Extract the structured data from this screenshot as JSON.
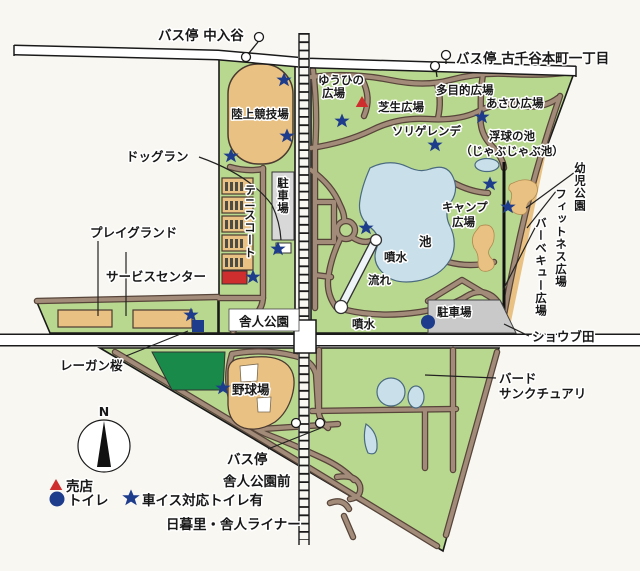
{
  "map_title_context": "舎人公園 園内マップ",
  "bus_stops": {
    "nakairiya": "バス停 中入谷",
    "kojiya_honcho": "バス停 古千谷本町一丁目",
    "toneri_koen_mae_line1": "バス停",
    "toneri_koen_mae_line2": "舎人公園前"
  },
  "labels": {
    "athletics_field": "陸上競技場",
    "dog_run": "ドッグラン",
    "tennis_court": "テニスコート",
    "parking_north": "駐車場",
    "playground": "プレイグランド",
    "service_center": "サービスセンター",
    "reagan_sakura": "レーガン桜",
    "station_name": "舎人公園",
    "yuhi_plaza_line1": "ゆうひの",
    "yuhi_plaza_line2": "広場",
    "shibafu_plaza": "芝生広場",
    "tamokuteki_plaza": "多目的広場",
    "asahi_plaza": "あさひ広場",
    "sori_gelande": "ソリゲレンデ",
    "ukidama_pond_line1": "浮球の池",
    "ukidama_pond_line2": "（じゃぶじゃぶ池）",
    "camp_plaza_line1": "キャンプ",
    "camp_plaza_line2": "広場",
    "pond": "池",
    "fountain_upper": "噴水",
    "stream": "流れ",
    "fountain_lower": "噴水",
    "parking_south": "駐車場",
    "yoji_koen": "幼児公園",
    "fitness_plaza": "フィットネス広場",
    "bbq_plaza": "バーベキュー広場",
    "shobu_den": "ショウブ田",
    "bird_sanctuary_line1": "バード",
    "bird_sanctuary_line2": "サンクチュアリ",
    "baseball_field": "野球場",
    "liner": "日暮里・舎人ライナー",
    "compass_north": "N"
  },
  "legend": {
    "shop": "売店",
    "toilet": "トイレ",
    "wheelchair_toilet": "車イス対応トイレ有"
  },
  "colors": {
    "park_green": "#b9d88f",
    "dark_green": "#1a8a4a",
    "field_tan": "#e9c183",
    "water_blue": "#c9e0ea",
    "road_brown": "#a38b79",
    "road_outline": "#57453a",
    "parking_gray": "#cfcfcf",
    "shop_red": "#cf2e2e",
    "toilet_navy": "#1e3c8c",
    "paper": "#f8f7f2"
  }
}
